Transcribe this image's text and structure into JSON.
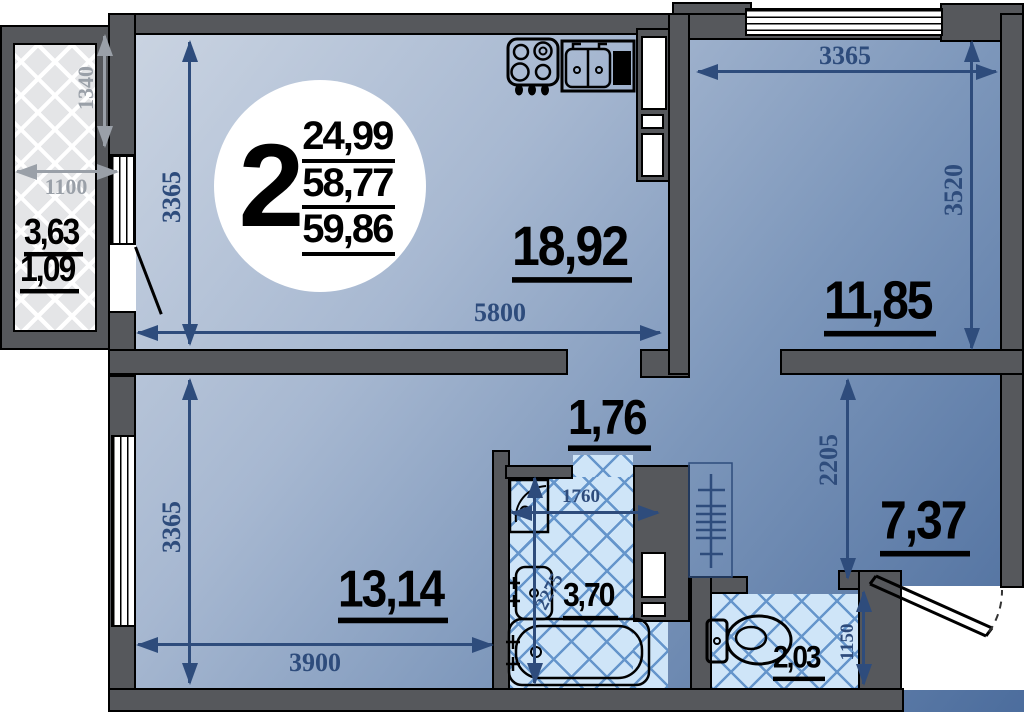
{
  "apartment": {
    "number": "2",
    "areas": {
      "living": "24,99",
      "total": "58,77",
      "total_with_balcony": "59,86"
    }
  },
  "rooms": {
    "kitchen_living": {
      "area": "18,92",
      "width_mm": "5800",
      "depth_mm": "3365"
    },
    "bedroom_right": {
      "area": "11,85",
      "width_mm": "3365",
      "depth_mm": "3520"
    },
    "bedroom_left": {
      "area": "13,14",
      "width_mm": "3900",
      "depth_mm": "3365"
    },
    "corridor": {
      "area": "1,76"
    },
    "bathroom": {
      "area": "3,70",
      "width_mm": "1760",
      "depth_mm": "2275"
    },
    "hallway": {
      "area": "7,37",
      "depth_mm": "2205"
    },
    "wc": {
      "area": "2,03",
      "depth_mm": "1150"
    },
    "balcony": {
      "area": "3,63",
      "area_reduced": "1,09",
      "width_mm": "1100",
      "depth_mm": "1340"
    }
  },
  "colors": {
    "wall": "#56585c",
    "dimension_blue": "#2e4c7c",
    "dimension_gray": "#9aa0a8",
    "floor_light": "#cdd6e3",
    "floor_dark": "#4c6d9d",
    "wet_room_fill": "#cfe5f8",
    "wet_room_hatch_line": "#6595cb",
    "balcony_fill": "#e4e5e7"
  },
  "fixtures": [
    "stove-icon",
    "kitchen-sink-icon",
    "washbasin-icon",
    "laundry-basin-icon",
    "bathtub-icon",
    "toilet-icon",
    "coat-rack-icon",
    "balcony-door",
    "entrance-door"
  ]
}
